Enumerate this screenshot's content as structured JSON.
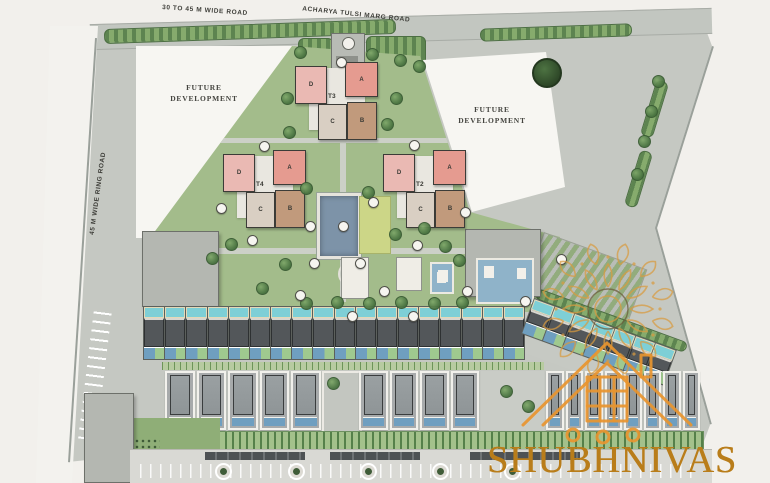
{
  "brand": {
    "name": "SHUBHNIVAS"
  },
  "roads": {
    "top_left": "30 TO 45 M WIDE ROAD",
    "top_right": "ACHARYA TULSI MARG ROAD",
    "left": "45 M WIDE RING ROAD"
  },
  "parcels": {
    "future_left": "FUTURE DEVELOPMENT",
    "future_right": "FUTURE DEVELOPMENT"
  },
  "towers": [
    {
      "label": "T3",
      "blocks": [
        "D",
        "A",
        "C",
        "B"
      ]
    },
    {
      "label": "T4",
      "blocks": [
        "D",
        "A",
        "C",
        "B"
      ]
    },
    {
      "label": "T2",
      "blocks": [
        "D",
        "A",
        "C",
        "B"
      ]
    }
  ],
  "repeat": {
    "row1_units": 18,
    "row1_angled_units": 7,
    "row2_left_units": 5,
    "row2_mid_units": 4,
    "row2_right_units": 8
  },
  "colors": {
    "block_d": "#eab9b3",
    "block_a": "#e59b90",
    "block_c": "#d9cfc3",
    "block_b": "#c19a7c",
    "pool_blue": "#7d93a8",
    "villa_pool": "#6f9fc0",
    "teal": "#7ecfd6",
    "gold": "#d89b3f",
    "house_orange": "#e8952f",
    "brand_text": "#b97d1a"
  }
}
